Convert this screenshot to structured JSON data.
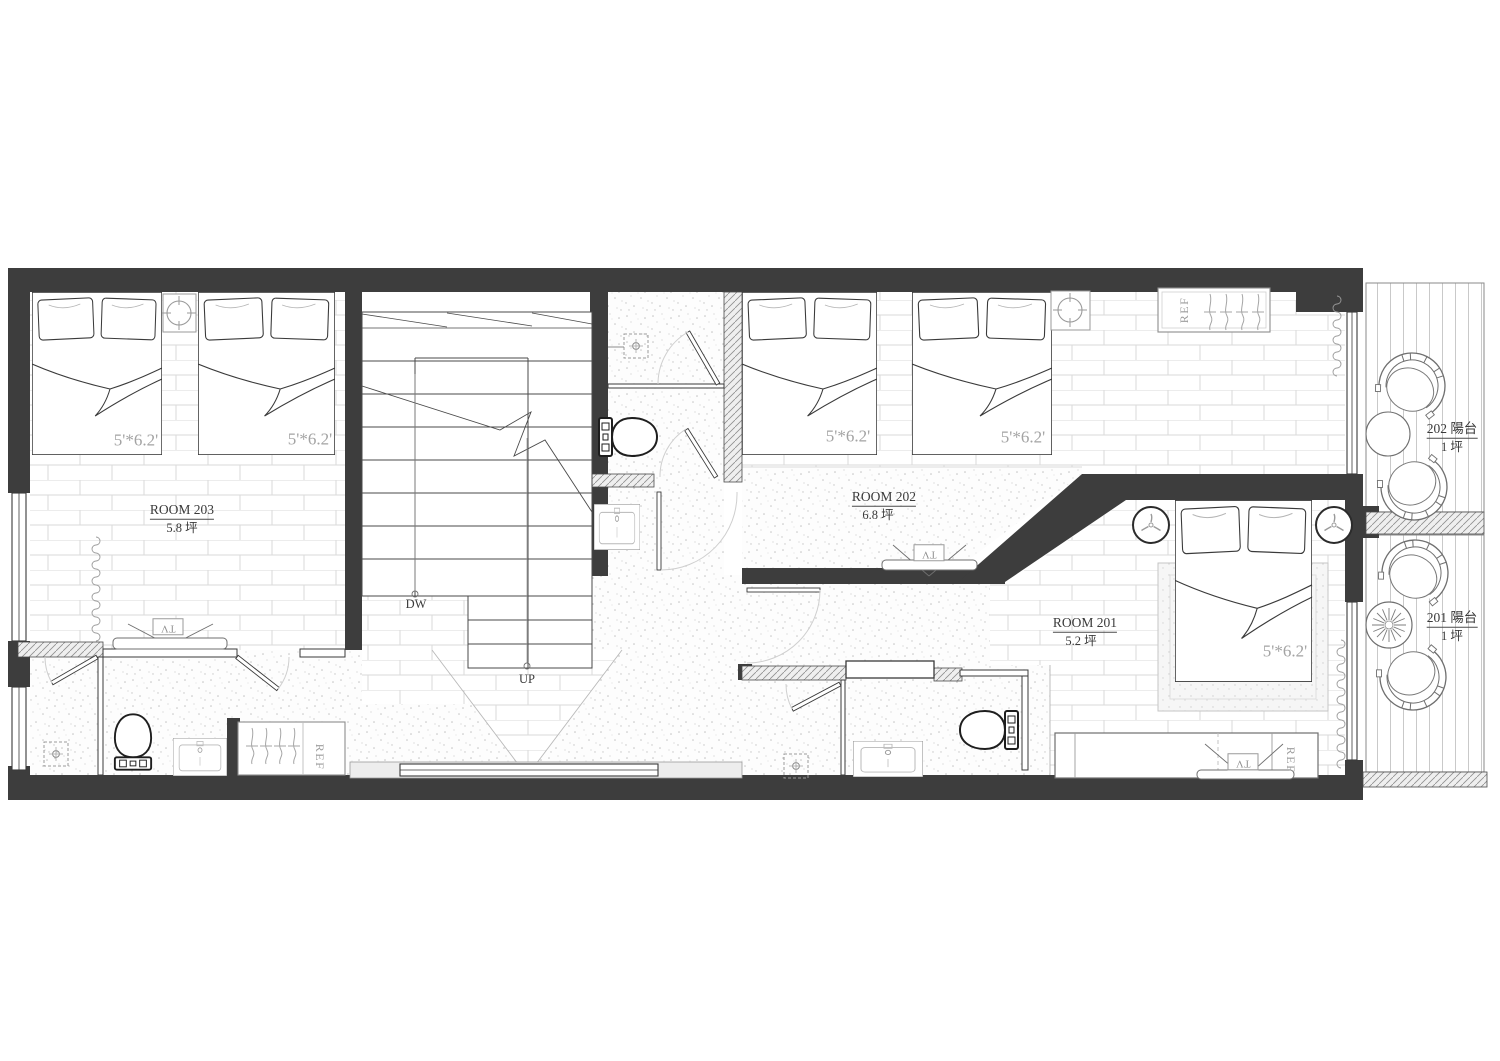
{
  "colors": {
    "wall": "#3d3d3d",
    "line": "#4a4a4a",
    "brick_line": "#d9d9d9",
    "dim_text": "#a3a3a3",
    "label_text": "#3a3a3a"
  },
  "rooms": {
    "room203": {
      "name": "ROOM 203",
      "area": "5.8 坪"
    },
    "room202": {
      "name": "ROOM 202",
      "area": "6.8 坪"
    },
    "room201": {
      "name": "ROOM 201",
      "area": "5.2 坪"
    },
    "balcony202": {
      "name": "202 陽台",
      "area": "1 坪"
    },
    "balcony201": {
      "name": "201 陽台",
      "area": "1 坪"
    }
  },
  "stairs": {
    "down": "DW",
    "up": "UP"
  },
  "bed_size_label": "5'*6.2'",
  "fixture_labels": {
    "tv": "TV",
    "fridge": "REF"
  }
}
